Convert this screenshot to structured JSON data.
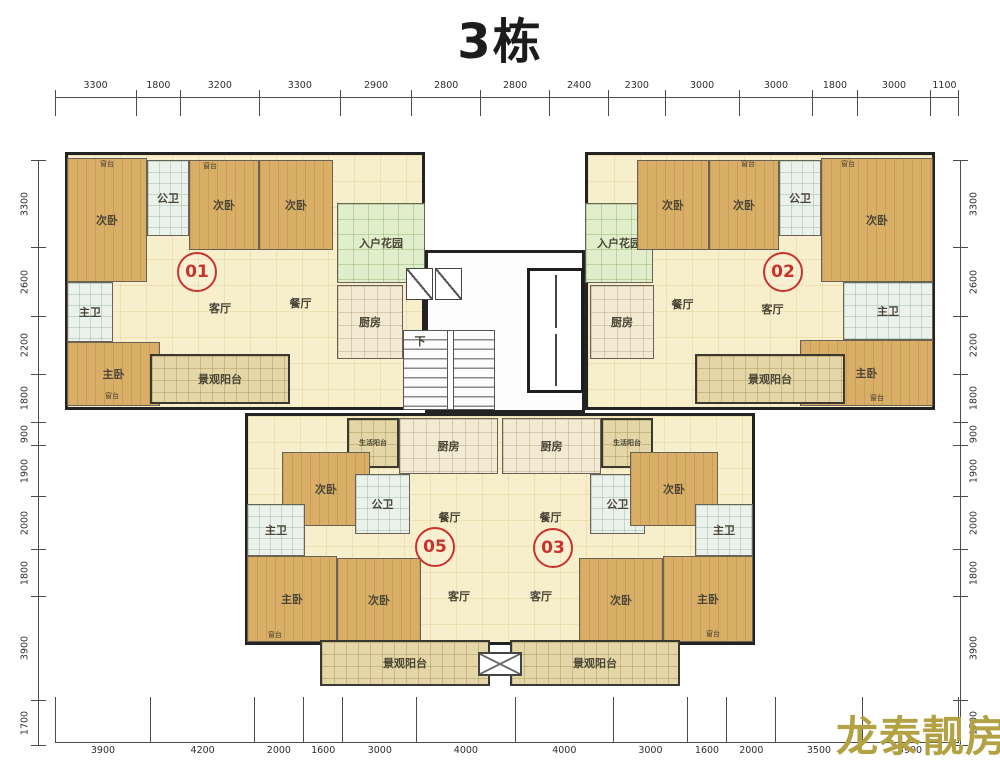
{
  "title": "3栋",
  "watermark": {
    "text": "龙泰靓房",
    "color": "#b2a244"
  },
  "colors": {
    "wall": "#232323",
    "floor_cream": "#f7eecb",
    "wood": "#d9af67",
    "garden_green": "#e0eecb",
    "balcony_tan": "#e4d6a6",
    "unit_badge_red": "#c8332d",
    "watermark_gold": "#b2a244"
  },
  "dims": {
    "top": [
      3300,
      1800,
      3200,
      3300,
      2900,
      2800,
      2800,
      2400,
      2300,
      3000,
      3000,
      1800,
      3000,
      1100
    ],
    "bottom": [
      3900,
      4200,
      2000,
      1600,
      3000,
      4000,
      4000,
      3000,
      1600,
      2000,
      3500,
      3900
    ],
    "left": [
      3300,
      2600,
      2200,
      1800,
      900,
      1900,
      2000,
      1800,
      3900,
      1700
    ],
    "right": [
      3300,
      2600,
      2200,
      1800,
      900,
      1900,
      2000,
      1800,
      3900,
      1700
    ]
  },
  "plan": {
    "outlines": [
      {
        "x": 65,
        "y": 152,
        "w": 360,
        "h": 258,
        "bg": "cream"
      },
      {
        "x": 585,
        "y": 152,
        "w": 350,
        "h": 258,
        "bg": "cream"
      },
      {
        "x": 425,
        "y": 250,
        "w": 160,
        "h": 163,
        "bg": "white"
      },
      {
        "x": 245,
        "y": 413,
        "w": 510,
        "h": 232,
        "bg": "cream"
      }
    ],
    "rooms": [
      {
        "l": "次卧",
        "x": 67,
        "y": 158,
        "w": 80,
        "h": 124,
        "t": "wood"
      },
      {
        "l": "公卫",
        "x": 147,
        "y": 160,
        "w": 42,
        "h": 76,
        "t": "bath"
      },
      {
        "l": "次卧",
        "x": 189,
        "y": 160,
        "w": 70,
        "h": 90,
        "t": "wood"
      },
      {
        "l": "次卧",
        "x": 259,
        "y": 160,
        "w": 74,
        "h": 90,
        "t": "wood"
      },
      {
        "l": "主卫",
        "x": 67,
        "y": 282,
        "w": 46,
        "h": 60,
        "t": "bath"
      },
      {
        "l": "主卧",
        "x": 67,
        "y": 342,
        "w": 93,
        "h": 64,
        "t": "wood"
      },
      {
        "l": "客厅",
        "x": 165,
        "y": 265,
        "w": 110,
        "h": 85,
        "t": "area"
      },
      {
        "l": "餐厅",
        "x": 268,
        "y": 255,
        "w": 65,
        "h": 95,
        "t": "area"
      },
      {
        "l": "景观阳台",
        "x": 150,
        "y": 354,
        "w": 140,
        "h": 50,
        "t": "balcony"
      },
      {
        "l": "入户花园",
        "x": 337,
        "y": 203,
        "w": 88,
        "h": 80,
        "t": "green"
      },
      {
        "l": "厨房",
        "x": 337,
        "y": 285,
        "w": 66,
        "h": 74,
        "t": "kitchen"
      },
      {
        "l": "",
        "x": 406,
        "y": 268,
        "w": 27,
        "h": 32,
        "t": "xbox"
      },
      {
        "l": "",
        "x": 435,
        "y": 268,
        "w": 27,
        "h": 32,
        "t": "xbox"
      },
      {
        "l": "",
        "x": 403,
        "y": 330,
        "w": 92,
        "h": 80,
        "t": "stairs"
      },
      {
        "l": "",
        "x": 527,
        "y": 268,
        "w": 57,
        "h": 125,
        "t": "elevator"
      },
      {
        "l": "入户花园",
        "x": 585,
        "y": 203,
        "w": 68,
        "h": 80,
        "t": "green"
      },
      {
        "l": "厨房",
        "x": 590,
        "y": 285,
        "w": 64,
        "h": 74,
        "t": "kitchen"
      },
      {
        "l": "次卧",
        "x": 637,
        "y": 160,
        "w": 72,
        "h": 90,
        "t": "wood"
      },
      {
        "l": "次卧",
        "x": 709,
        "y": 160,
        "w": 70,
        "h": 90,
        "t": "wood"
      },
      {
        "l": "公卫",
        "x": 779,
        "y": 160,
        "w": 42,
        "h": 76,
        "t": "bath"
      },
      {
        "l": "次卧",
        "x": 821,
        "y": 158,
        "w": 112,
        "h": 124,
        "t": "wood"
      },
      {
        "l": "主卫",
        "x": 843,
        "y": 282,
        "w": 90,
        "h": 58,
        "t": "bath"
      },
      {
        "l": "主卧",
        "x": 800,
        "y": 340,
        "w": 133,
        "h": 66,
        "t": "wood"
      },
      {
        "l": "餐厅",
        "x": 640,
        "y": 258,
        "w": 85,
        "h": 92,
        "t": "area"
      },
      {
        "l": "客厅",
        "x": 730,
        "y": 268,
        "w": 85,
        "h": 82,
        "t": "area"
      },
      {
        "l": "景观阳台",
        "x": 695,
        "y": 354,
        "w": 150,
        "h": 50,
        "t": "balcony"
      },
      {
        "l": "生活阳台",
        "x": 347,
        "y": 418,
        "w": 52,
        "h": 50,
        "t": "balcony",
        "s": 1
      },
      {
        "l": "厨房",
        "x": 399,
        "y": 418,
        "w": 99,
        "h": 56,
        "t": "kitchen"
      },
      {
        "l": "次卧",
        "x": 282,
        "y": 452,
        "w": 88,
        "h": 74,
        "t": "wood"
      },
      {
        "l": "公卫",
        "x": 355,
        "y": 474,
        "w": 55,
        "h": 60,
        "t": "bath"
      },
      {
        "l": "餐厅",
        "x": 412,
        "y": 486,
        "w": 75,
        "h": 62,
        "t": "area"
      },
      {
        "l": "主卫",
        "x": 247,
        "y": 504,
        "w": 58,
        "h": 52,
        "t": "bath"
      },
      {
        "l": "主卧",
        "x": 247,
        "y": 556,
        "w": 90,
        "h": 86,
        "t": "wood"
      },
      {
        "l": "次卧",
        "x": 337,
        "y": 558,
        "w": 84,
        "h": 84,
        "t": "wood"
      },
      {
        "l": "客厅",
        "x": 420,
        "y": 562,
        "w": 78,
        "h": 68,
        "t": "area"
      },
      {
        "l": "景观阳台",
        "x": 320,
        "y": 640,
        "w": 170,
        "h": 46,
        "t": "balcony"
      },
      {
        "l": "厨房",
        "x": 502,
        "y": 418,
        "w": 99,
        "h": 56,
        "t": "kitchen"
      },
      {
        "l": "生活阳台",
        "x": 601,
        "y": 418,
        "w": 52,
        "h": 50,
        "t": "balcony",
        "s": 1
      },
      {
        "l": "公卫",
        "x": 590,
        "y": 474,
        "w": 55,
        "h": 60,
        "t": "bath"
      },
      {
        "l": "次卧",
        "x": 630,
        "y": 452,
        "w": 88,
        "h": 74,
        "t": "wood"
      },
      {
        "l": "餐厅",
        "x": 513,
        "y": 486,
        "w": 75,
        "h": 62,
        "t": "area"
      },
      {
        "l": "主卫",
        "x": 695,
        "y": 504,
        "w": 58,
        "h": 52,
        "t": "bath"
      },
      {
        "l": "主卧",
        "x": 663,
        "y": 556,
        "w": 90,
        "h": 86,
        "t": "wood"
      },
      {
        "l": "次卧",
        "x": 579,
        "y": 558,
        "w": 84,
        "h": 84,
        "t": "wood"
      },
      {
        "l": "客厅",
        "x": 502,
        "y": 562,
        "w": 78,
        "h": 68,
        "t": "area"
      },
      {
        "l": "景观阳台",
        "x": 510,
        "y": 640,
        "w": 170,
        "h": 46,
        "t": "balcony"
      },
      {
        "l": "",
        "x": 478,
        "y": 652,
        "w": 44,
        "h": 24,
        "t": "connector"
      }
    ],
    "units": [
      {
        "id": "01",
        "x": 197,
        "y": 272
      },
      {
        "id": "02",
        "x": 783,
        "y": 272
      },
      {
        "id": "05",
        "x": 435,
        "y": 547
      },
      {
        "id": "03",
        "x": 553,
        "y": 548
      }
    ],
    "small_labels": [
      {
        "t": "窗台",
        "x": 107,
        "y": 164
      },
      {
        "t": "窗台",
        "x": 210,
        "y": 166
      },
      {
        "t": "窗台",
        "x": 748,
        "y": 164
      },
      {
        "t": "窗台",
        "x": 848,
        "y": 164
      },
      {
        "t": "窗台",
        "x": 112,
        "y": 396
      },
      {
        "t": "窗台",
        "x": 877,
        "y": 398
      },
      {
        "t": "窗台",
        "x": 275,
        "y": 635
      },
      {
        "t": "窗台",
        "x": 713,
        "y": 634
      },
      {
        "t": "下",
        "x": 420,
        "y": 341,
        "big": 1
      }
    ]
  }
}
